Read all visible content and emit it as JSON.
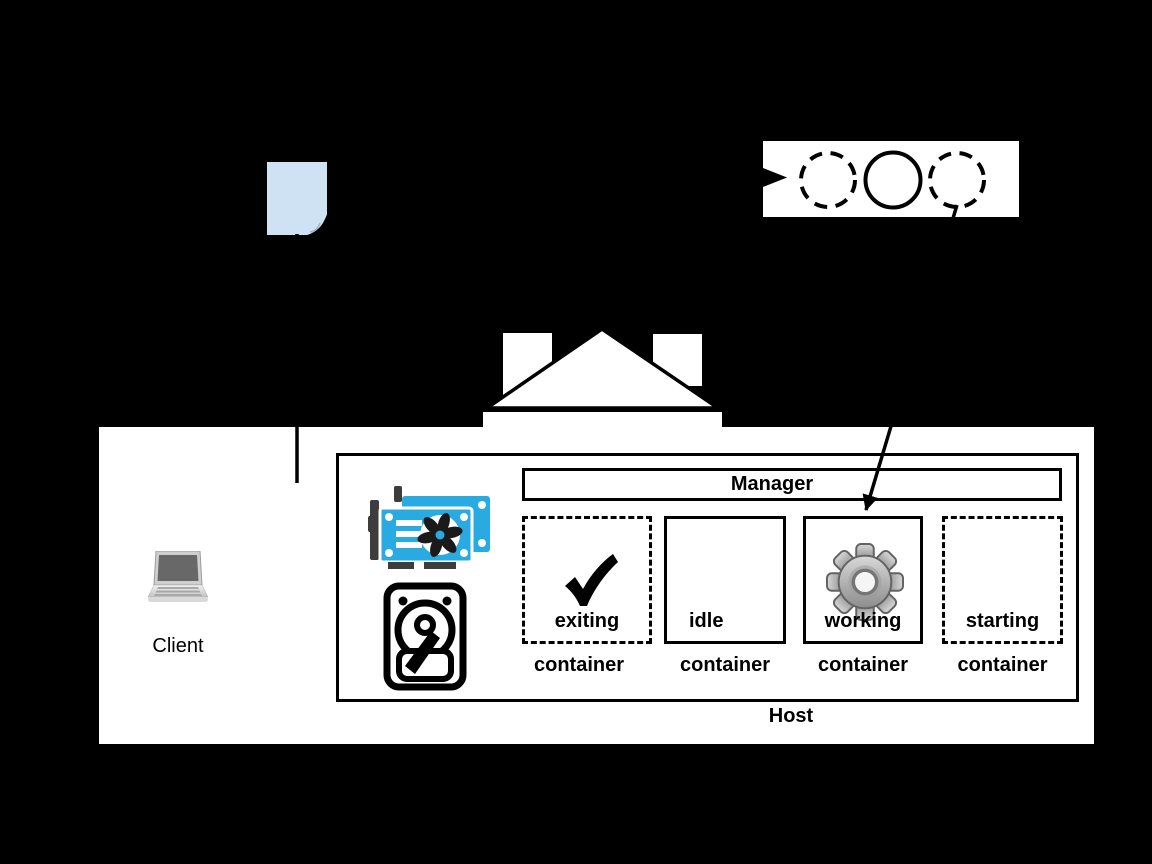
{
  "colors": {
    "background": "#000000",
    "panel_white": "#ffffff",
    "document_blue": "#cfe2f3",
    "gpu_blue": "#29abe2",
    "hardware_dark": "#3d3d3d",
    "gear_gray": "#b4b4b4",
    "line_black": "#000000"
  },
  "state_diagram": {
    "circles": [
      {
        "style": "dashed"
      },
      {
        "style": "solid"
      },
      {
        "style": "dashed"
      }
    ]
  },
  "host_panel": {
    "client_label": "Client",
    "host_label": "Host",
    "manager_label": "Manager",
    "containers": [
      {
        "state": "exiting",
        "type_label": "container",
        "border": "dashed",
        "icon": "check"
      },
      {
        "state": "idle",
        "type_label": "container",
        "border": "solid",
        "icon": ""
      },
      {
        "state": "working",
        "type_label": "container",
        "border": "solid",
        "icon": "gear"
      },
      {
        "state": "starting",
        "type_label": "container",
        "border": "dashed",
        "icon": ""
      }
    ]
  }
}
